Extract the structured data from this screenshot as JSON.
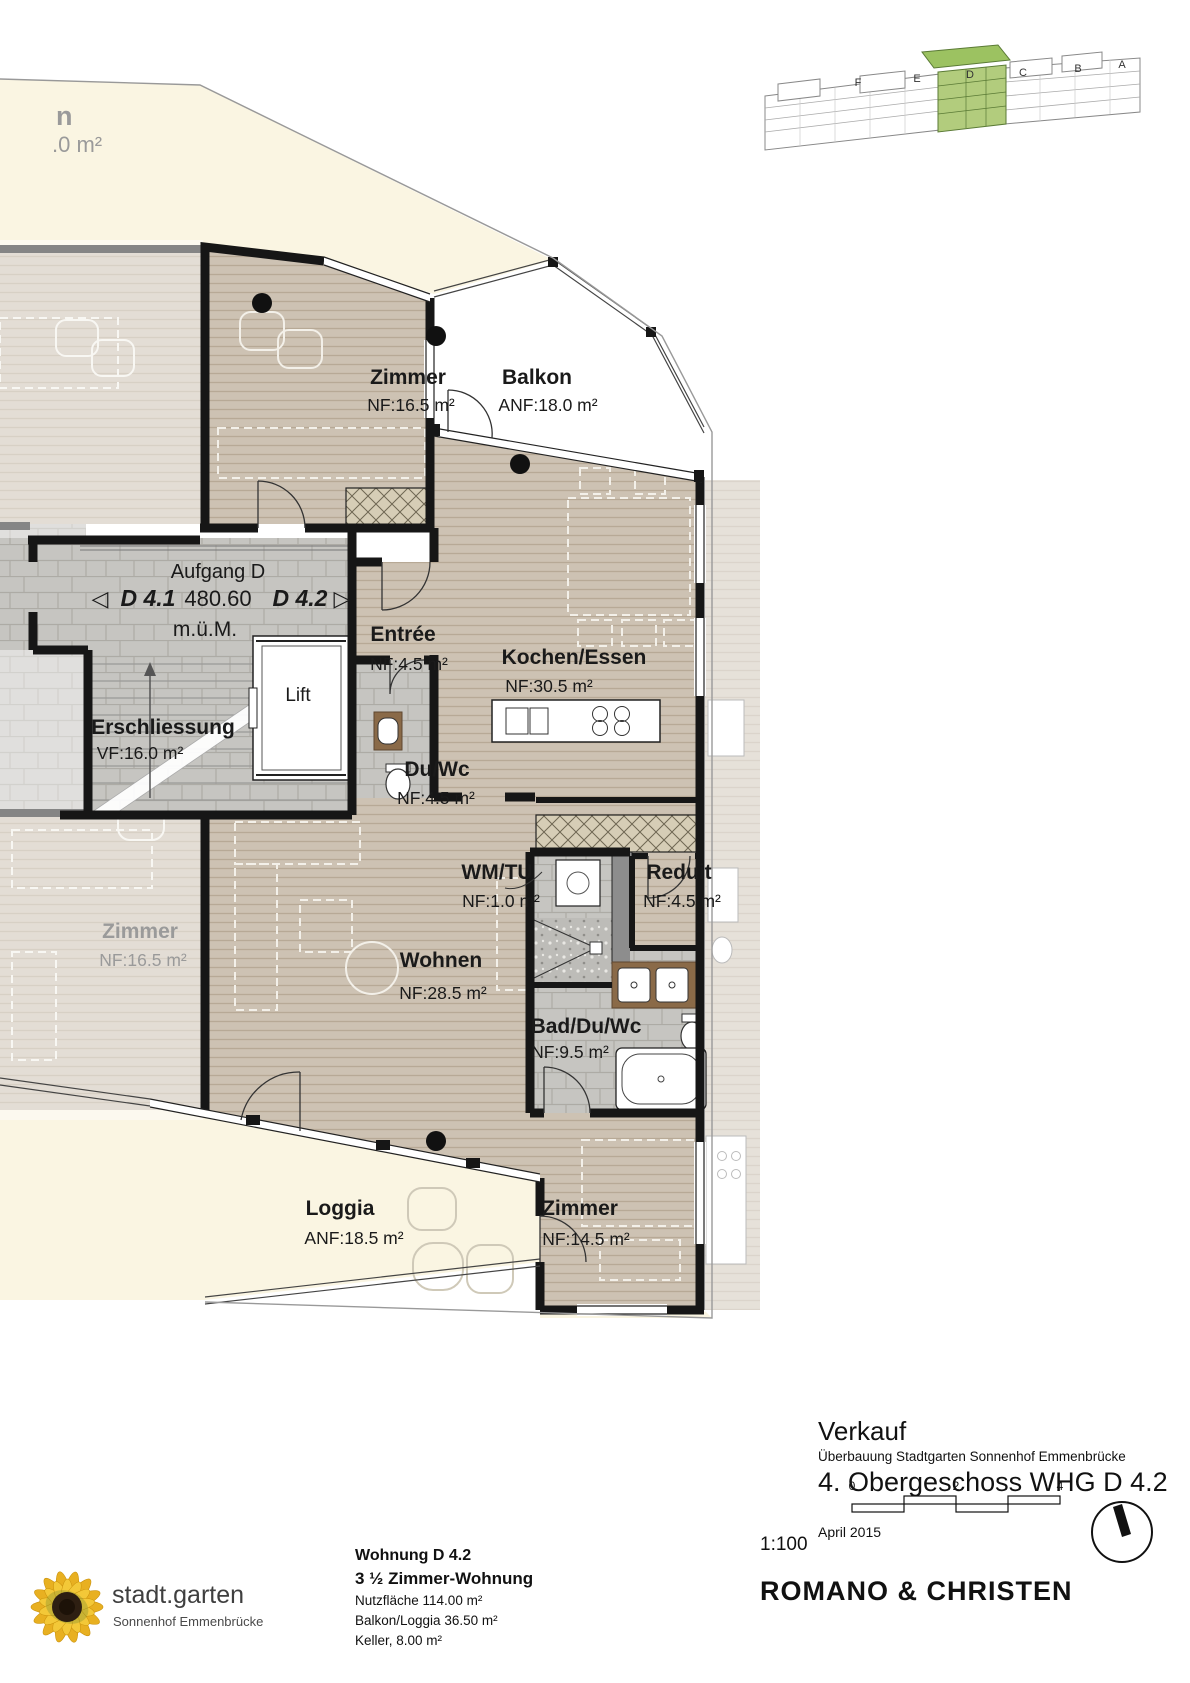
{
  "plan": {
    "stairwell_label": "Aufgang D",
    "unit_left": "D 4.1",
    "elevation": "480.60",
    "unit_right": "D 4.2",
    "elevation_unit": "m.ü.M.",
    "arrow_left": "◁",
    "arrow_right": "▷",
    "lift": "Lift",
    "adjacent_partial": {
      "name_fragment": "n",
      "area_fragment": ".0 m²"
    },
    "rooms": {
      "zimmer_top": {
        "name": "Zimmer",
        "area": "NF:16.5 m²"
      },
      "balkon": {
        "name": "Balkon",
        "area": "ANF:18.0 m²"
      },
      "entree": {
        "name": "Entrée",
        "area": "NF:4.5 m²"
      },
      "kochen_essen": {
        "name": "Kochen/Essen",
        "area": "NF:30.5 m²"
      },
      "erschliessung": {
        "name": "Erschliessung",
        "area": "VF:16.0 m²"
      },
      "du_wc": {
        "name": "Du/Wc",
        "area": "NF:4.5 m²"
      },
      "wm_tu": {
        "name": "WM/TU",
        "area": "NF:1.0 m²"
      },
      "reduit": {
        "name": "Reduit",
        "area": "NF:4.5 m²"
      },
      "wohnen": {
        "name": "Wohnen",
        "area": "NF:28.5 m²"
      },
      "zimmer_left": {
        "name": "Zimmer",
        "area": "NF:16.5 m²"
      },
      "bad_du_wc": {
        "name": "Bad/Du/Wc",
        "area": "NF:9.5 m²"
      },
      "loggia": {
        "name": "Loggia",
        "area": "ANF:18.5 m²"
      },
      "zimmer_bottom": {
        "name": "Zimmer",
        "area": "NF:14.5 m²"
      }
    }
  },
  "building_key": {
    "blocks": [
      "F",
      "E",
      "D",
      "C",
      "B",
      "A"
    ],
    "highlight": "D",
    "highlight_color": "#a8c973"
  },
  "title_block": {
    "sale_label": "Verkauf",
    "project": "Überbauung Stadtgarten Sonnenhof Emmenbrücke",
    "sheet_title": "4. Obergeschoss WHG D 4.2",
    "date": "April 2015",
    "scale": "1:100",
    "scale_ticks": [
      "0",
      "2",
      "4"
    ],
    "architect": "ROMANO & CHRISTEN"
  },
  "apartment_info": {
    "title": "Wohnung D 4.2",
    "type": "3 ½ Zimmer-Wohnung",
    "lines": [
      "Nutzfläche 114.00 m²",
      "Balkon/Loggia 36.50 m²",
      "Keller, 8.00 m²"
    ]
  },
  "logo": {
    "name": "stadt.garten",
    "subtitle": "Sonnenhof Emmenbrücke"
  }
}
